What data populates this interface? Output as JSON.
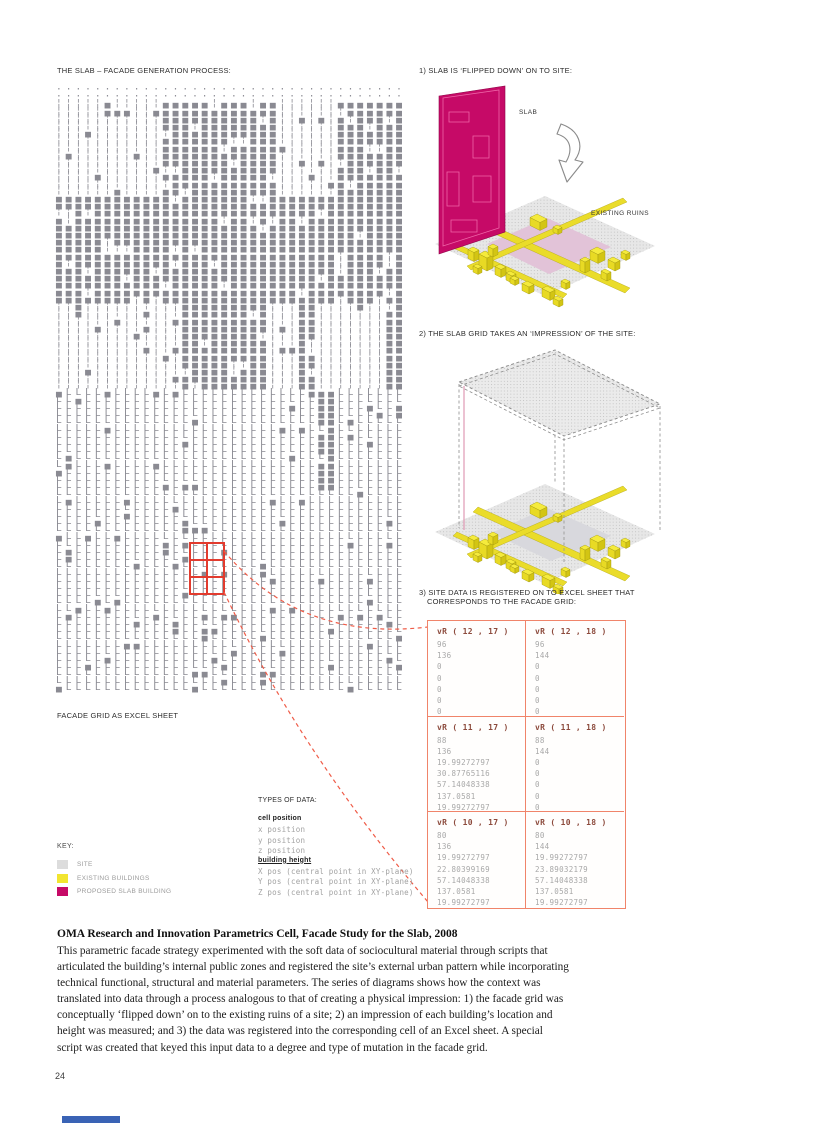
{
  "page": {
    "number": "24"
  },
  "headings": {
    "left": "THE SLAB – FACADE GENERATION PROCESS:",
    "step1": "1) SLAB IS ‘FLIPPED DOWN’ ON TO SITE:",
    "step2": "2) THE SLAB GRID TAKES AN ‘IMPRESSION’ OF THE SITE:",
    "step3_line1": "3) SITE DATA IS REGISTERED ON TO EXCEL SHEET THAT",
    "step3_line2": "CORRESPONDS TO THE FACADE GRID:"
  },
  "diagram1": {
    "slab_label": "SLAB",
    "ruins_label": "EXISTING RUINS"
  },
  "facade_grid": {
    "label": "FACADE GRID AS EXCEL SHEET",
    "cols": 36,
    "bands": [
      {
        "rows": 2,
        "dense": "·",
        "sparse": "·",
        "density": 0
      },
      {
        "rows": 13,
        "dense": "▄",
        "sparse": "¦",
        "density": 0.8
      },
      {
        "rows": 15,
        "dense": "▄",
        "sparse": "¦",
        "density": 0.62
      },
      {
        "rows": 12,
        "dense": "▄",
        "sparse": "¦",
        "density": 0.3
      },
      {
        "rows": 14,
        "dense": "▄",
        "sparse": "L",
        "density": 0.15
      },
      {
        "rows": 28,
        "dense": "▄",
        "sparse": "L",
        "density": 0.07
      }
    ]
  },
  "types_of_data": {
    "title": "TYPES OF DATA:",
    "items": [
      {
        "text": "cell position",
        "style": "bold"
      },
      {
        "text": "x position",
        "style": "mono"
      },
      {
        "text": "y position",
        "style": "mono"
      },
      {
        "text": "z position",
        "style": "mono"
      },
      {
        "text": "building height",
        "style": "boldu"
      },
      {
        "text": "X pos (central point in XY-plane)",
        "style": "mono"
      },
      {
        "text": "Y pos (central point in XY-plane)",
        "style": "mono"
      },
      {
        "text": "Z pos (central point in XY-plane)",
        "style": "mono"
      }
    ]
  },
  "key": {
    "title": "KEY:",
    "items": [
      {
        "label": "SITE",
        "color": "#dcdcdc",
        "pattern": "dots",
        "icon": "site-swatch-icon"
      },
      {
        "label": "EXISTING BUILDINGS",
        "color": "#f2e530",
        "pattern": "",
        "icon": "existing-buildings-swatch-icon"
      },
      {
        "label": "PROPOSED SLAB BUILDING",
        "color": "#c60a67",
        "pattern": "",
        "icon": "proposed-slab-swatch-icon"
      }
    ]
  },
  "excel": {
    "cells": [
      {
        "header": "vR ( 12 , 17 )",
        "values": [
          "96",
          "136",
          "0",
          "0",
          "0",
          "0",
          "0"
        ]
      },
      {
        "header": "vR ( 12 , 18 )",
        "values": [
          "96",
          "144",
          "0",
          "0",
          "0",
          "0",
          "0"
        ]
      },
      {
        "header": "vR ( 11 , 17 )",
        "values": [
          "88",
          "136",
          "19.99272797",
          "30.87765116",
          "57.14048338",
          "137.0581",
          "19.99272797"
        ]
      },
      {
        "header": "vR ( 11 , 18 )",
        "values": [
          "88",
          "144",
          "0",
          "0",
          "0",
          "0",
          "0"
        ]
      },
      {
        "header": "vR ( 10 , 17 )",
        "values": [
          "80",
          "136",
          "19.99272797",
          "22.80399169",
          "57.14048338",
          "137.0581",
          "19.99272797"
        ]
      },
      {
        "header": "vR ( 10 , 18 )",
        "values": [
          "80",
          "144",
          "19.99272797",
          "23.89032179",
          "57.14048338",
          "137.0581",
          "19.99272797"
        ]
      }
    ]
  },
  "caption": {
    "title": "OMA Research and Innovation Parametrics Cell, Facade Study for the Slab, 2008",
    "body": "This parametric facade strategy experimented with the soft data of sociocultural material through scripts that articulated the building’s internal public zones and registered the site’s external urban pattern while incorporating technical functional, structural and material parameters. The series of diagrams shows how the context was translated into data through a process analogous to that of creating a physical impression: 1) the facade grid was conceptually ‘flipped down’ on to the existing ruins of a site; 2) an impression of each building’s location and height was measured; and 3) the data was registered into the corresponding cell of an Excel sheet. A special script was created that keyed this input data to a degree and type of mutation in the facade grid."
  },
  "colors": {
    "slab_magenta": "#c60a67",
    "building_yellow": "#f2e530",
    "site_gray": "#e7e7e7",
    "red_accent": "#e23b2e",
    "table_border": "#f0846a",
    "footer_blue": "#3a63b5"
  }
}
